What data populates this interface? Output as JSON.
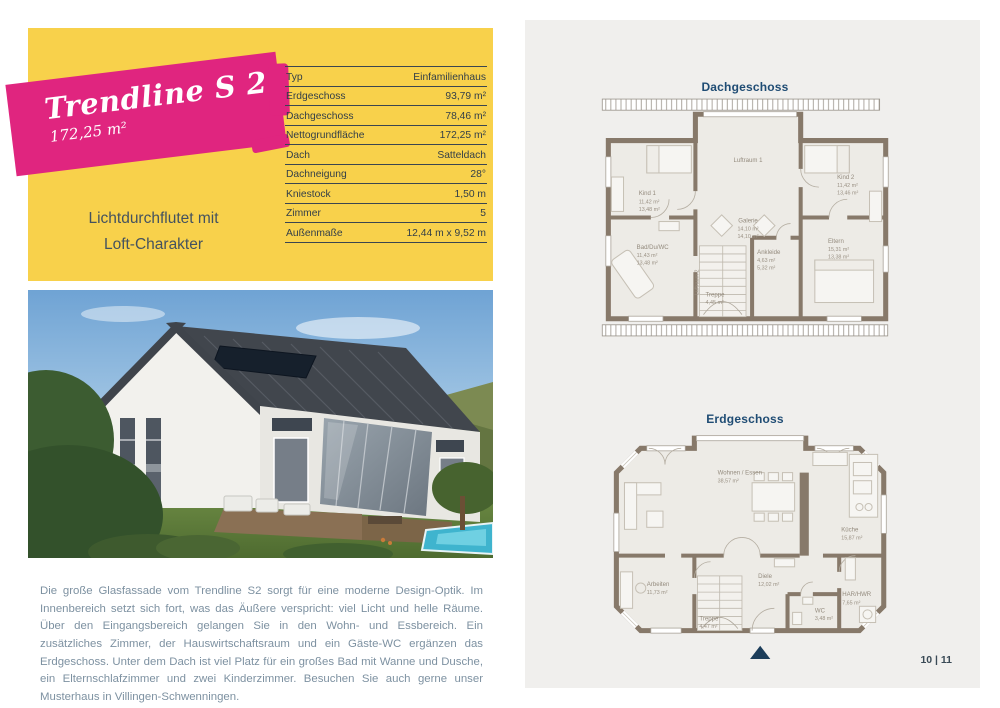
{
  "header": {
    "title": "Trendline S 2",
    "area": "172,25 m²",
    "tagline_line1": "Lichtdurchflutet mit",
    "tagline_line2": "Loft-Charakter"
  },
  "specs": {
    "rows": [
      {
        "label": "Typ",
        "value": "Einfamilienhaus"
      },
      {
        "label": "Erdgeschoss",
        "value": "93,79 m²"
      },
      {
        "label": "Dachgeschoss",
        "value": "78,46 m²"
      },
      {
        "label": "Nettogrundfläche",
        "value": "172,25 m²"
      },
      {
        "label": "Dach",
        "value": "Satteldach"
      },
      {
        "label": "Dachneigung",
        "value": "28°"
      },
      {
        "label": "Kniestock",
        "value": "1,50 m"
      },
      {
        "label": "Zimmer",
        "value": "5"
      },
      {
        "label": "Außenmaße",
        "value": "12,44 m x 9,52 m"
      }
    ]
  },
  "description": "Die große Glasfassade vom Trendline S2 sorgt für eine moderne Design-Optik. Im Innenbereich setzt sich fort, was das Äußere verspricht: viel Licht und helle Räume. Über den Eingangsbereich gelangen Sie in den Wohn- und Essbereich. Ein zusätzliches Zimmer, der Hauswirtschaftsraum und ein Gäste-WC ergänzen das Erdgeschoss. Unter dem Dach ist viel Platz für ein großes Bad mit Wanne und Dusche, ein Elternschlafzimmer und zwei Kinderzimmer. Besuchen Sie auch gerne unser Musterhaus in Villingen-Schwenningen.",
  "plans": {
    "dachgeschoss": {
      "title": "Dachgeschoss",
      "rooms": {
        "luftraum1": {
          "name": "Luftraum 1"
        },
        "kind1": {
          "name": "Kind 1",
          "area_a": "11,42 m²",
          "area_b": "13,48 m²"
        },
        "kind2": {
          "name": "Kind 2",
          "area_a": "11,42 m²",
          "area_b": "13,46 m²"
        },
        "galerie": {
          "name": "Galerie",
          "area_a": "14,10 m²",
          "area_b": "14,10 m²"
        },
        "bad": {
          "name": "Bad/Du/WC",
          "area_a": "11,43 m²",
          "area_b": "13,48 m²"
        },
        "ankleide": {
          "name": "Ankleide",
          "area_a": "4,63 m²",
          "area_b": "5,32 m²"
        },
        "eltern": {
          "name": "Eltern",
          "area_a": "15,31 m²",
          "area_b": "13,38 m²"
        },
        "treppe": {
          "name": "Treppe",
          "area_a": "4,45 m²"
        },
        "luftraum2": {
          "name": "Luftraum 2"
        }
      }
    },
    "erdgeschoss": {
      "title": "Erdgeschoss",
      "rooms": {
        "wohnen": {
          "name": "Wohnen / Essen",
          "area_a": "38,57 m²"
        },
        "kueche": {
          "name": "Küche",
          "area_a": "15,87 m²"
        },
        "arbeiten": {
          "name": "Arbeiten",
          "area_a": "11,73 m²"
        },
        "diele": {
          "name": "Diele",
          "area_a": "12,02 m²"
        },
        "wc": {
          "name": "WC",
          "area_a": "3,48 m²"
        },
        "hwr": {
          "name": "HAR/HWR",
          "area_a": "7,65 m²"
        },
        "treppe": {
          "name": "Treppe",
          "area_a": "4,47 m²"
        }
      }
    }
  },
  "footer": {
    "page_number": "10 | 11"
  },
  "colors": {
    "brand_pink": "#E0257F",
    "card_yellow": "#F8D14B",
    "heading_blue": "#1F4C74",
    "spec_text": "#323E48",
    "body_text": "#7D91A1",
    "plan_wall": "#87796A",
    "entrance_marker": "#1C3D5A",
    "panel_background": "#F0EFED"
  }
}
